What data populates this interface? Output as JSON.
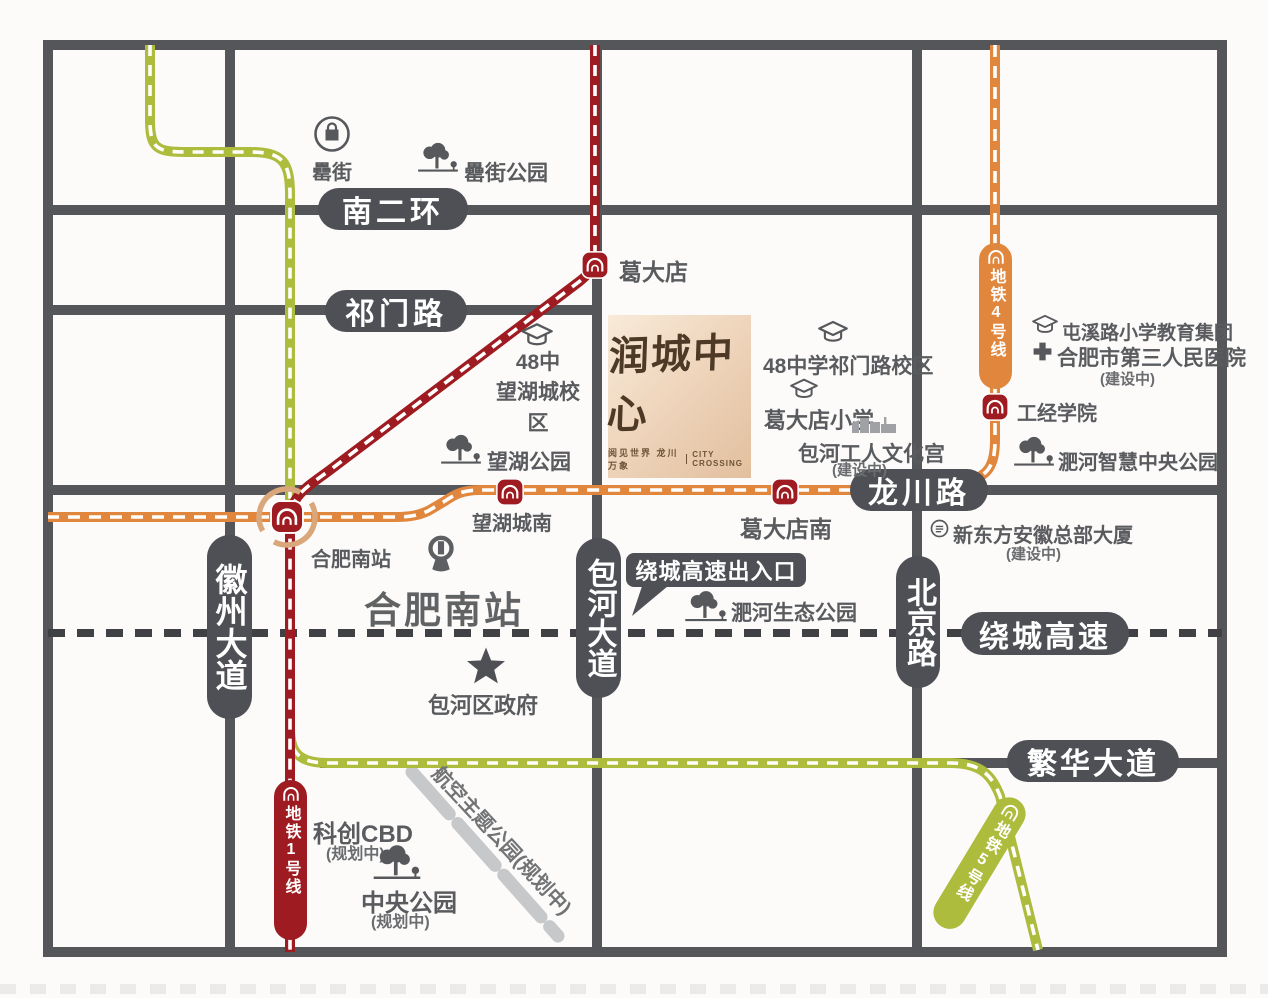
{
  "project": {
    "name": "润城中心",
    "tagline_cn": "阅见世界 龙川万象",
    "tagline_en": "CITY CROSSING"
  },
  "roads": {
    "south_second_ring": "南二环",
    "qimen_road": "祁门路",
    "longchuan_road": "龙川路",
    "huizhou_avenue": "徽州大道",
    "baohe_avenue": "包河大道",
    "beijing_road": "北京路",
    "ring_expressway": "绕城高速",
    "fanhua_avenue": "繁华大道",
    "expressway_exit": "绕城高速出入口"
  },
  "metro": {
    "line1_label": "地铁1号线",
    "line4_label": "地铁4号线",
    "line5_label": "地铁5号线",
    "line1_color": "#9e1c21",
    "line4_color": "#e1873d",
    "line5_color": "#adbc3c"
  },
  "stations": {
    "gedadian": "葛大店",
    "wanghucheng_south": "望湖城南",
    "gedadian_south": "葛大店南",
    "hefei_south_metro": "合肥南站",
    "gongjing_college": "工经学院"
  },
  "pois": {
    "lei_street": "罍街",
    "lei_street_park": "罍街公园",
    "school48_wanghu_line1": "48中",
    "school48_wanghu_line2": "望湖城校区",
    "wanghu_park": "望湖公园",
    "school48_qimen": "48中学祁门路校区",
    "gedadian_primary": "葛大店小学",
    "baohe_workers_palace": "包河工人文化宫",
    "tunxi_primary_group": "屯溪路小学教育集团",
    "third_peoples_hospital": "合肥市第三人民医院",
    "feihe_smart_central_park": "淝河智慧中央公园",
    "new_oriental_hq": "新东方安徽总部大厦",
    "hefei_south_railway": "合肥南站",
    "feihe_eco_park": "淝河生态公园",
    "baohe_district_gov": "包河区政府",
    "kechuang_cbd": "科创CBD",
    "central_park": "中央公园",
    "aviation_theme_park": "航空主题公园(规划中)",
    "under_construction": "(建设中)",
    "planned": "(规划中)"
  },
  "colors": {
    "road_gray": "#54565a",
    "pill_gray": "#4e5055",
    "highway_dash": "#3f4144",
    "interchange_ring": "#d9a77a",
    "label_text": "#595b5e",
    "planned_park_dash": "#c6c8ca"
  }
}
